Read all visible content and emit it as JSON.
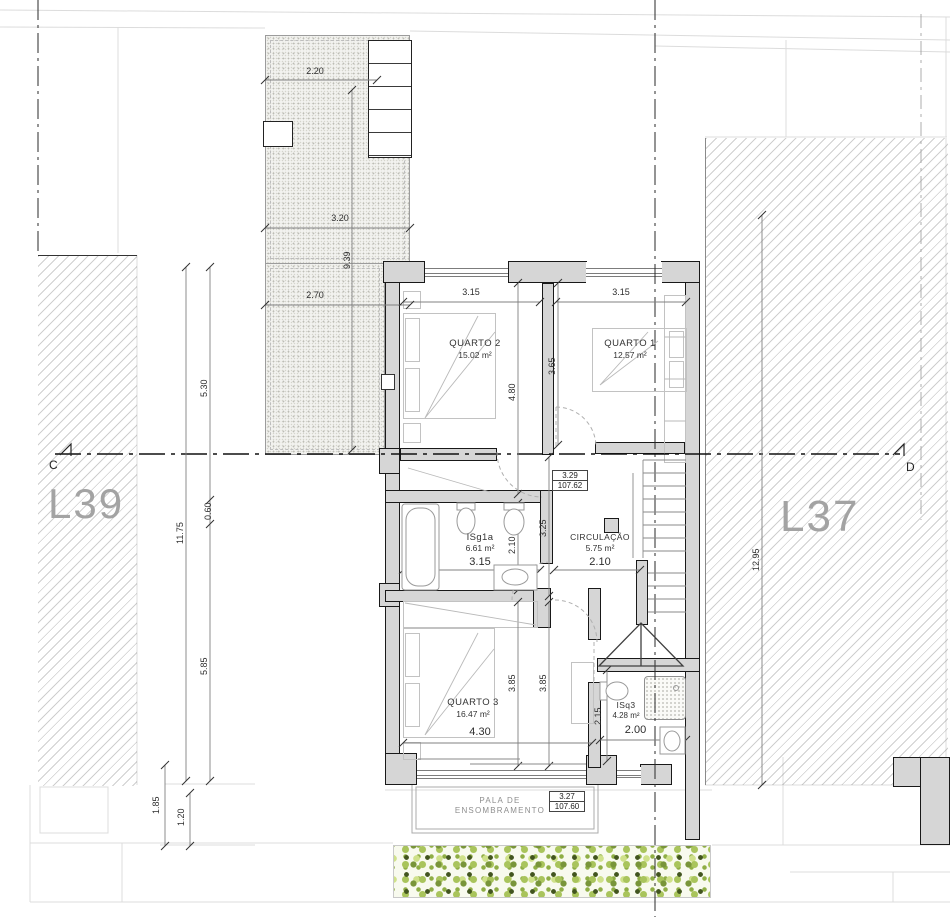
{
  "drawing": {
    "lots": {
      "left_label": "L39",
      "right_label": "L37"
    },
    "section_markers": {
      "left": "C",
      "right": "D"
    },
    "rooms": {
      "quarto2": {
        "name": "QUARTO 2",
        "area": "15.02 m²"
      },
      "quarto1": {
        "name": "QUARTO 1",
        "area": "12.57 m²"
      },
      "isg1a": {
        "name": "ISg1a",
        "area": "6.61 m²"
      },
      "circulacao": {
        "name": "CIRCULAÇÃO",
        "area": "5.75 m²"
      },
      "quarto3": {
        "name": "QUARTO 3",
        "area": "16.47 m²"
      },
      "isq3": {
        "name": "ISq3",
        "area": "4.28 m²"
      }
    },
    "levels": {
      "hall": {
        "relative": "3.29",
        "absolute": "107.62"
      },
      "canopy": {
        "relative": "3.27",
        "absolute": "107.60"
      }
    },
    "canopy_label": {
      "line1": "PALA DE",
      "line2": "ENSOMBRAMENTO"
    },
    "dims": {
      "terrace_width": "2.20",
      "terrace_mid": "3.20",
      "terrace_length": "9.39",
      "terrace_low": "2.70",
      "left_upper": "5.30",
      "left_total": "11.75",
      "left_small": "0.60",
      "left_lower": "5.85",
      "bottom_a": "1.85",
      "bottom_b": "1.20",
      "right_total": "12.95",
      "quarto2_w": "3.15",
      "quarto1_w": "3.15",
      "quarto2_h": "4.80",
      "quarto1_h": "3.65",
      "hall_h": "3.25",
      "isg1a_h": "2.10",
      "isg1a_w": "3.15",
      "circulacao_w": "2.10",
      "quarto3_h_a": "3.85",
      "quarto3_h_b": "3.85",
      "quarto3_w": "4.30",
      "isq3_h": "2.15",
      "isq3_w": "2.00"
    },
    "colors": {
      "wall_fill": "#d6d6d6",
      "wall_line": "#191919",
      "lot_label": "#a3a3a3",
      "hedge_dark": "#42551f",
      "hedge_mid": "#79953a",
      "hedge_light": "#a9c45c",
      "hedge_pale": "#cfe18a",
      "section_line": "#111111"
    }
  }
}
